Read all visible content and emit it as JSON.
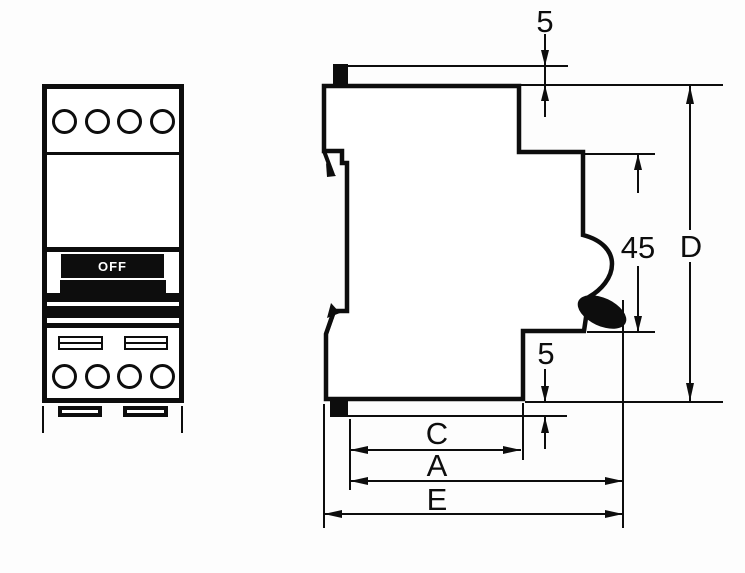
{
  "diagram": {
    "type": "technical-drawing",
    "subject": "modular circuit breaker front and side elevation with dimensions",
    "colors": {
      "ink": "#0d0d0d",
      "background": "#fdfdfd"
    },
    "front_view": {
      "toggle_label": "OFF",
      "top_terminal_count": 4,
      "bottom_terminal_count": 4
    },
    "side_view": {
      "dims": {
        "top_tab_height": "5",
        "handle_recess_height": "45",
        "overall_height": "D",
        "bottom_tab_height": "5",
        "width_c": "C",
        "width_a": "A",
        "width_e": "E"
      }
    }
  }
}
